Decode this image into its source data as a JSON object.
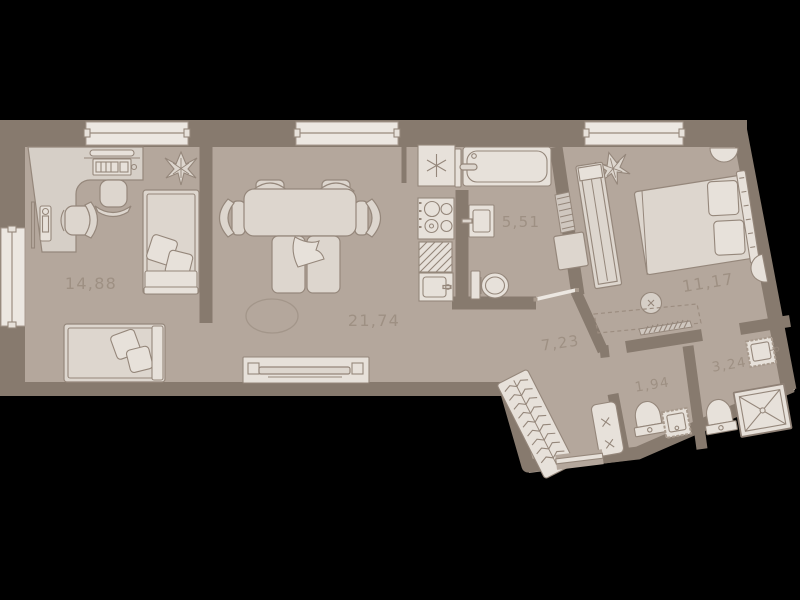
{
  "rooms": [
    {
      "area": "14,88"
    },
    {
      "area": "21,74"
    },
    {
      "area": "5,51"
    },
    {
      "area": "7,23"
    },
    {
      "area": "11,17"
    },
    {
      "area": "1,94"
    },
    {
      "area": "3,24"
    }
  ],
  "colors": {
    "background": "#000000",
    "floor": "#b4a79c",
    "walls": "#877a6e",
    "furniture": "#ddd6ce",
    "furniture_light": "#e7e1da",
    "outline": "#95877b",
    "window": "#ece7e1",
    "room_label_text": "#9e9083"
  }
}
